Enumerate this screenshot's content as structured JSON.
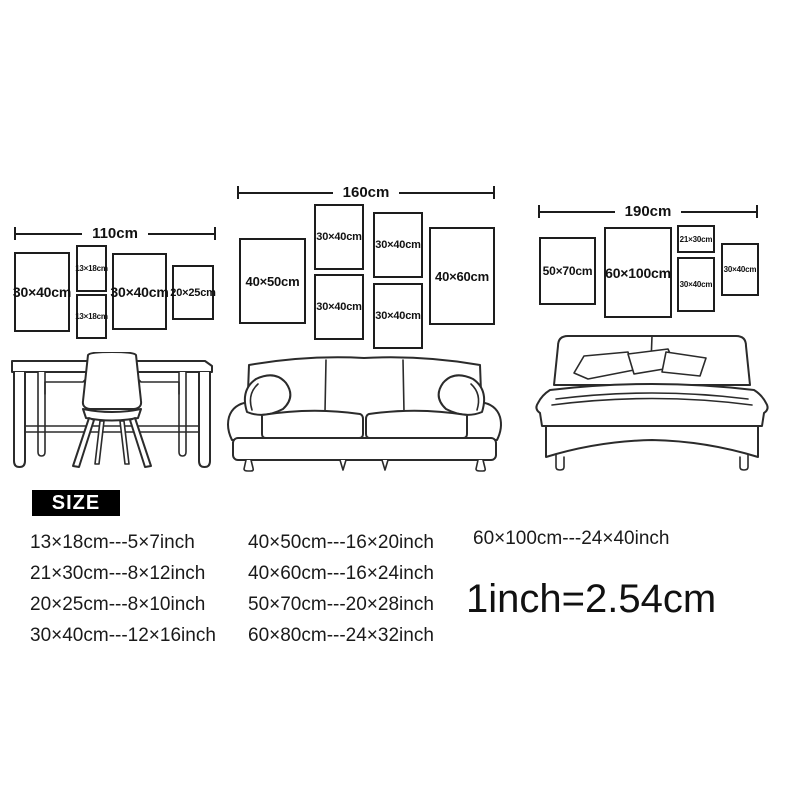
{
  "walls": [
    {
      "dimension": "110cm",
      "frames": [
        {
          "label": "30×40cm"
        },
        {
          "label": "13×18cm"
        },
        {
          "label": "13×18cm"
        },
        {
          "label": "30×40cm"
        },
        {
          "label": "20×25cm"
        }
      ]
    },
    {
      "dimension": "160cm",
      "frames": [
        {
          "label": "40×50cm"
        },
        {
          "label": "30×40cm"
        },
        {
          "label": "30×40cm"
        },
        {
          "label": "30×40cm"
        },
        {
          "label": "30×40cm"
        },
        {
          "label": "40×60cm"
        }
      ]
    },
    {
      "dimension": "190cm",
      "frames": [
        {
          "label": "50×70cm"
        },
        {
          "label": "60×100cm"
        },
        {
          "label": "21×30cm"
        },
        {
          "label": "30×40cm"
        },
        {
          "label": "30×40cm"
        }
      ]
    }
  ],
  "furniture": [
    {
      "icon": "desk-chair-illustration"
    },
    {
      "icon": "sofa-illustration"
    },
    {
      "icon": "bed-illustration"
    }
  ],
  "size_section": {
    "badge": "SIZE",
    "columns": [
      [
        "13×18cm---5×7inch",
        "21×30cm---8×12inch",
        "20×25cm---8×10inch",
        "30×40cm---12×16inch"
      ],
      [
        "40×50cm---16×20inch",
        "40×60cm---16×24inch",
        "50×70cm---20×28inch",
        "60×80cm---24×32inch"
      ],
      [
        "60×100cm---24×40inch"
      ]
    ],
    "conversion": "1inch=2.54cm"
  },
  "colors": {
    "ink": "#1c1c1c",
    "badge_bg": "#000000",
    "badge_text": "#ffffff",
    "background": "#ffffff"
  }
}
